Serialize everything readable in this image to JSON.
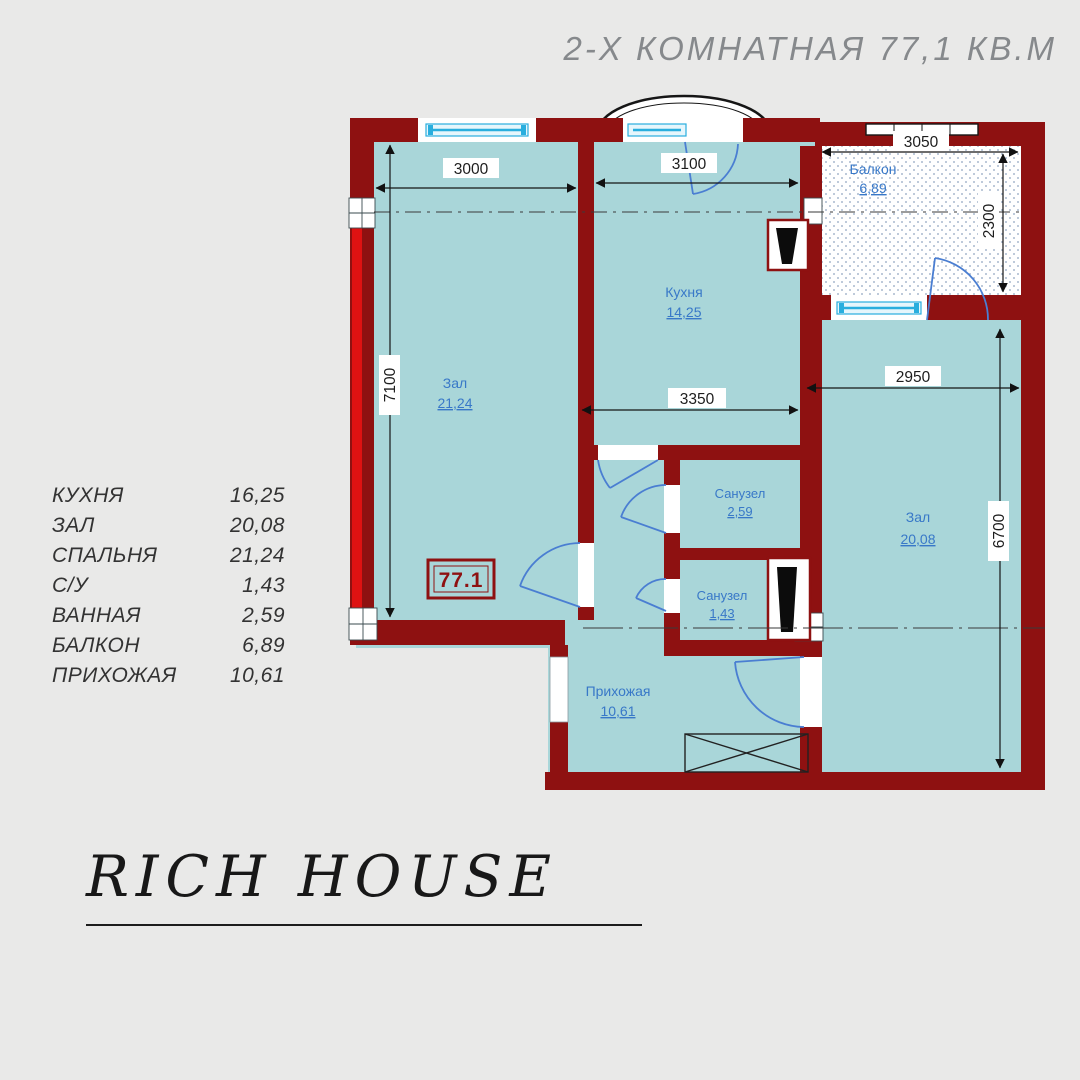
{
  "header": {
    "title": "2-Х КОМНАТНАЯ 77,1 КВ.М"
  },
  "legend": {
    "rows": [
      {
        "label": "КУХНЯ",
        "value": "16,25"
      },
      {
        "label": "ЗАЛ",
        "value": "20,08"
      },
      {
        "label": "СПАЛЬНЯ",
        "value": "21,24"
      },
      {
        "label": "С/У",
        "value": "1,43"
      },
      {
        "label": "ВАННАЯ",
        "value": "2,59"
      },
      {
        "label": "БАЛКОН",
        "value": "6,89"
      },
      {
        "label": "ПРИХОЖАЯ",
        "value": "10,61"
      }
    ]
  },
  "plan": {
    "badge": "77.1",
    "rooms": [
      {
        "name": "Зал",
        "area": "21,24"
      },
      {
        "name": "Кухня",
        "area": "14,25"
      },
      {
        "name": "Балкон",
        "area": "6,89"
      },
      {
        "name": "Санузел",
        "area": "2,59"
      },
      {
        "name": "Санузел",
        "area": "1,43"
      },
      {
        "name": "Прихожая",
        "area": "10,61"
      },
      {
        "name": "Зал",
        "area": "20,08"
      }
    ],
    "dims": {
      "left_room_width": "3000",
      "kitchen_width": "3100",
      "balcony_width": "3050",
      "balcony_depth": "2300",
      "left_side_height": "7100",
      "kitchen_inner_width": "3350",
      "right_room_width": "2950",
      "right_side_height": "6700"
    }
  },
  "footer": {
    "brand": "RICH HOUSE"
  },
  "colors": {
    "background": "#e9e9e8",
    "wall": "#8e1111",
    "wall_accent": "#de1212",
    "room_fill": "#a9d6d9",
    "label_blue": "#3878c8",
    "door_blue": "#4a7ed2",
    "window_cyan": "#29aede",
    "title_gray": "#86898c",
    "badge_red": "#8e1111"
  }
}
